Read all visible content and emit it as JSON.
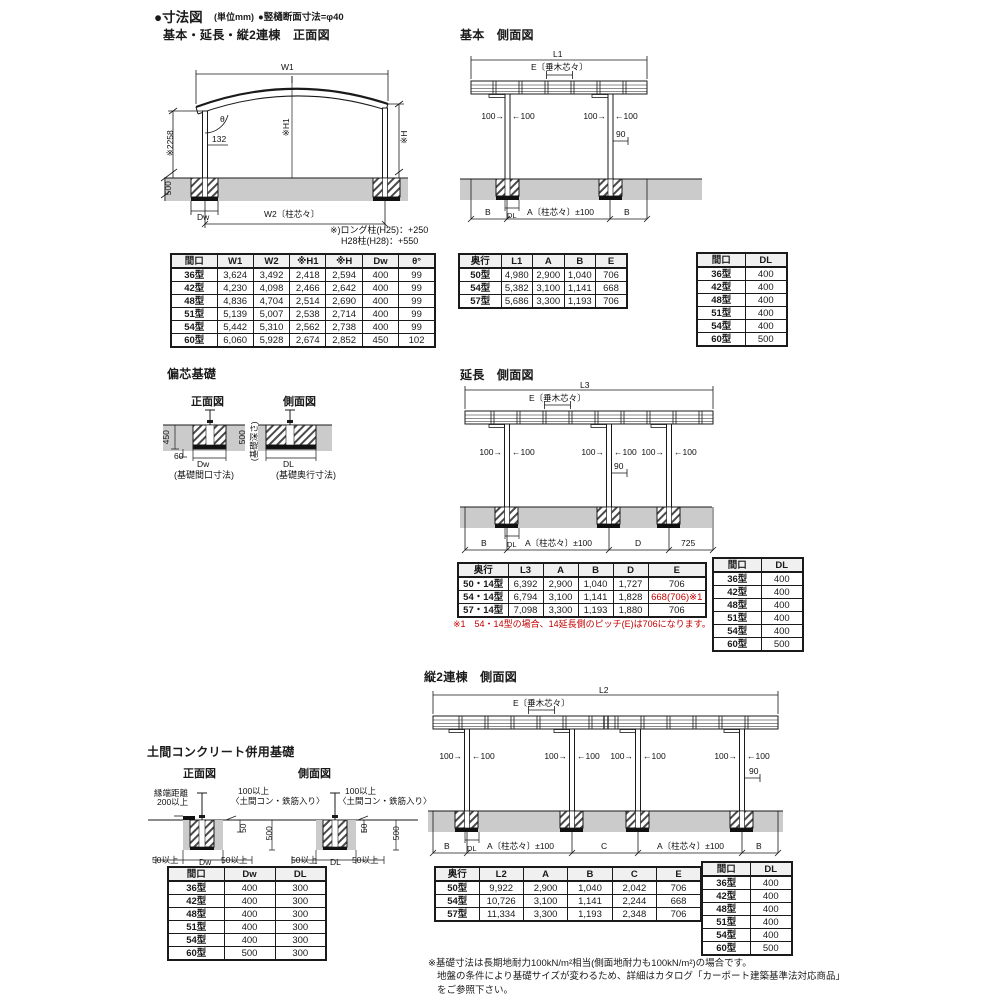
{
  "header": {
    "title": "●寸法図",
    "unit": "(単位mm)",
    "sub": "●竪樋断面寸法=φ40"
  },
  "dims": {
    "l1": "L1",
    "l2": "L2",
    "l3": "L3",
    "e": "E〔垂木芯々〕",
    "n100l": "100→",
    "n100r": "←100",
    "n90": "90",
    "b": "B",
    "a": "A〔柱芯々〕±100",
    "c": "C",
    "d": "D",
    "n725": "725",
    "dl": "DL",
    "dw": "Dw"
  },
  "front_view": {
    "heading": "基本・延長・縦2連棟　正面図",
    "labels": {
      "w1": "W1",
      "theta": "θ",
      "n2258": "※2258",
      "n132": "132",
      "h1": "※H1",
      "h": "※H",
      "n500": "500",
      "dw": "Dw",
      "w2": "W2〔柱芯々〕"
    },
    "note1": "※)ロング柱(H25)：+250",
    "note2": "H28柱(H28)：+550",
    "table": {
      "headers": [
        "間口",
        "W1",
        "W2",
        "※H1",
        "※H",
        "Dw",
        "θ°"
      ],
      "rows": [
        [
          "36型",
          "3,624",
          "3,492",
          "2,418",
          "2,594",
          "400",
          "99"
        ],
        [
          "42型",
          "4,230",
          "4,098",
          "2,466",
          "2,642",
          "400",
          "99"
        ],
        [
          "48型",
          "4,836",
          "4,704",
          "2,514",
          "2,690",
          "400",
          "99"
        ],
        [
          "51型",
          "5,139",
          "5,007",
          "2,538",
          "2,714",
          "400",
          "99"
        ],
        [
          "54型",
          "5,442",
          "5,310",
          "2,562",
          "2,738",
          "400",
          "99"
        ],
        [
          "60型",
          "6,060",
          "5,928",
          "2,674",
          "2,852",
          "450",
          "102"
        ]
      ]
    }
  },
  "side_basic": {
    "heading": "基本　側面図",
    "table": {
      "headers": [
        "奥行",
        "L1",
        "A",
        "B",
        "E"
      ],
      "rows": [
        [
          "50型",
          "4,980",
          "2,900",
          "1,040",
          "706"
        ],
        [
          "54型",
          "5,382",
          "3,100",
          "1,141",
          "668"
        ],
        [
          "57型",
          "5,686",
          "3,300",
          "1,193",
          "706"
        ]
      ]
    }
  },
  "side_ext": {
    "heading": "延長　側面図",
    "note": "※1　54・14型の場合、14延長側のピッチ(E)は706になります。",
    "table": {
      "headers": [
        "奥行",
        "L3",
        "A",
        "B",
        "D",
        "E"
      ],
      "rows": [
        [
          "50・14型",
          "6,392",
          "2,900",
          "1,040",
          "1,727",
          "706"
        ],
        [
          "54・14型",
          "6,794",
          "3,100",
          "1,141",
          "1,828",
          "668(706)※1"
        ],
        [
          "57・14型",
          "7,098",
          "3,300",
          "1,193",
          "1,880",
          "706"
        ]
      ],
      "red_cells": [
        [
          1,
          5
        ]
      ]
    }
  },
  "side_rento": {
    "heading": "縦2連棟　側面図",
    "table": {
      "headers": [
        "奥行",
        "L2",
        "A",
        "B",
        "C",
        "E"
      ],
      "rows": [
        [
          "50型",
          "9,922",
          "2,900",
          "1,040",
          "2,042",
          "706"
        ],
        [
          "54型",
          "10,726",
          "3,100",
          "1,141",
          "2,244",
          "668"
        ],
        [
          "57型",
          "11,334",
          "3,300",
          "1,193",
          "2,348",
          "706"
        ]
      ]
    }
  },
  "dl_table": {
    "headers": [
      "間口",
      "DL"
    ],
    "rows": [
      [
        "36型",
        "400"
      ],
      [
        "42型",
        "400"
      ],
      [
        "48型",
        "400"
      ],
      [
        "51型",
        "400"
      ],
      [
        "54型",
        "400"
      ],
      [
        "60型",
        "500"
      ]
    ]
  },
  "henshin": {
    "heading": "偏芯基礎",
    "front_label": "正面図",
    "side_label": "側面図",
    "labels": {
      "n450": "450",
      "n60": "60",
      "n500": "500",
      "depth": "(基礎深さ)",
      "dw": "Dw",
      "dl": "DL",
      "front_caption": "(基礎間口寸法)",
      "side_caption": "(基礎奥行寸法)"
    }
  },
  "doma": {
    "heading": "土間コンクリート併用基礎",
    "front_label": "正面図",
    "side_label": "側面図",
    "labels": {
      "edge1": "縁端距離",
      "edge2": "200以上",
      "top1": "100以上",
      "top2": "〈土間コン・鉄筋入り〉",
      "n50": "50",
      "n500": "500",
      "min50": "50以上",
      "dw": "Dw",
      "dl": "DL"
    },
    "table": {
      "headers": [
        "間口",
        "Dw",
        "DL"
      ],
      "rows": [
        [
          "36型",
          "400",
          "300"
        ],
        [
          "42型",
          "400",
          "300"
        ],
        [
          "48型",
          "400",
          "300"
        ],
        [
          "51型",
          "400",
          "300"
        ],
        [
          "54型",
          "400",
          "300"
        ],
        [
          "60型",
          "500",
          "300"
        ]
      ]
    }
  },
  "footer": {
    "note1": "※基礎寸法は長期地耐力100kN/m²相当(側面地耐力も100kN/m²)の場合です。",
    "note2": "地盤の条件により基礎サイズが変わるため、詳細はカタログ「カーポート建築基準法対応商品」",
    "note3": "をご参照下さい。"
  }
}
